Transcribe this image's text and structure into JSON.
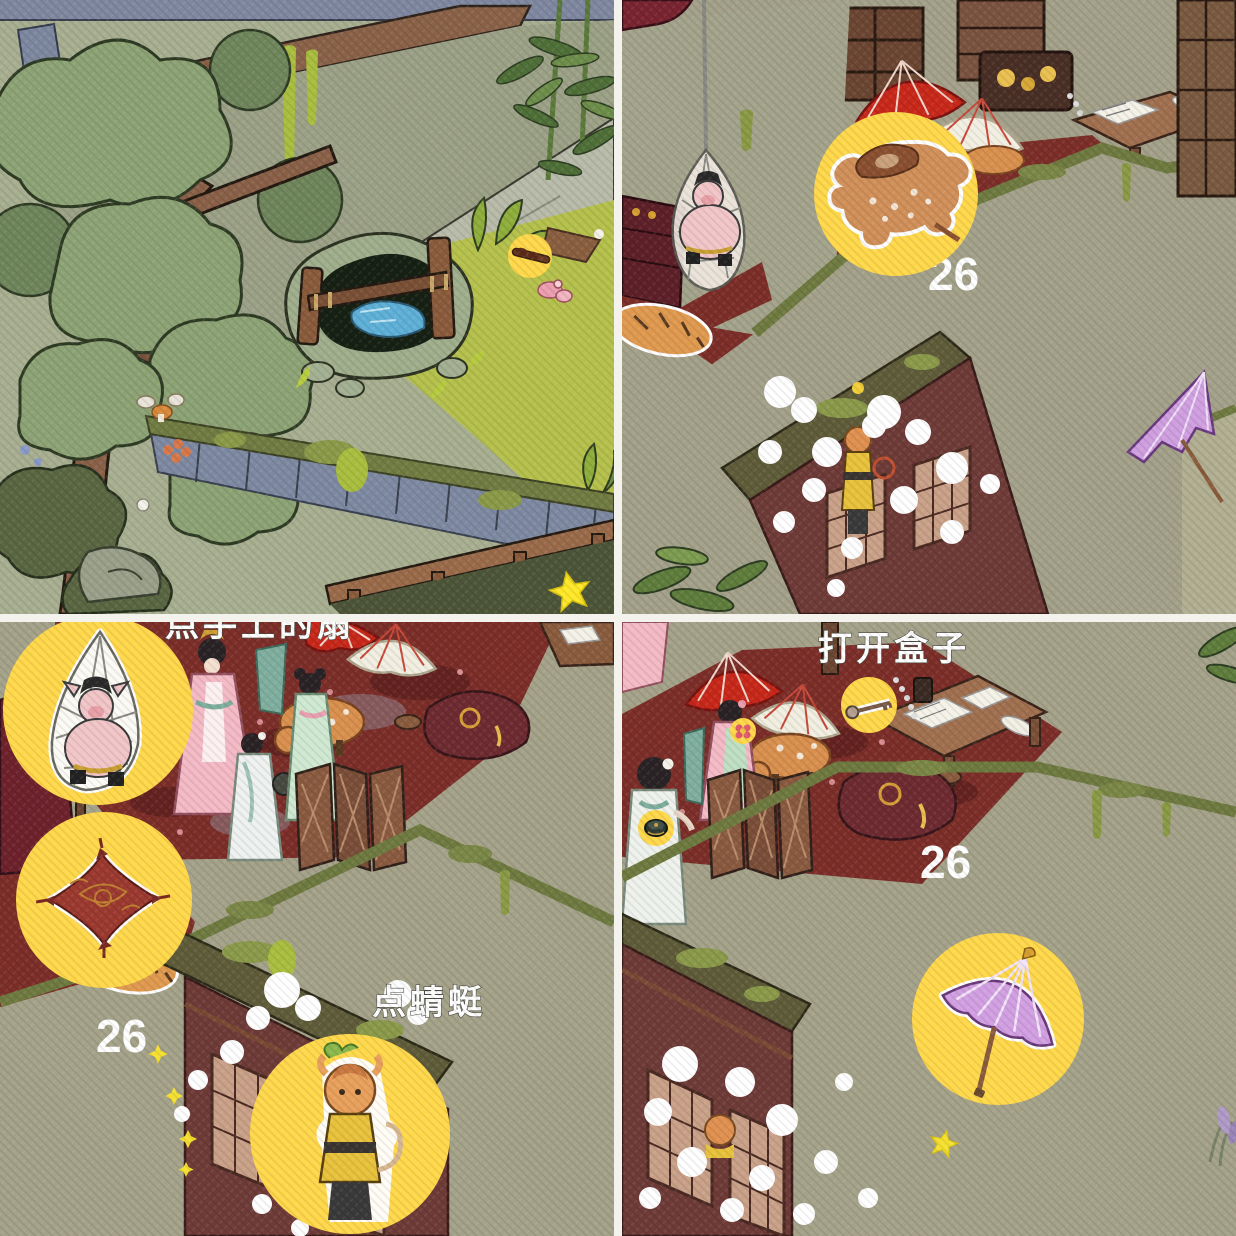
{
  "app": {
    "type": "isometric hidden-object puzzle game — 2x2 screenshot grid",
    "accent_yellow": "#FFD84B",
    "counter_color": "#FFFFFF"
  },
  "quadrants": {
    "top_left": {
      "scene": "mossy garden with stone spring, ginkgo trees, bamboo and tiled wall",
      "hints": [
        {
          "icon": "stick-skewer-icon"
        }
      ],
      "decor": [
        "yellow-star",
        "pink-blossom",
        "mushrooms",
        "white-dot"
      ]
    },
    "top_right": {
      "scene": "attic room with ladies, pig in hanging net, umbrellas, monkey in smoke",
      "counter": "26",
      "hints": [
        {
          "icon": "deer-pelt-sticker"
        }
      ],
      "decor": [
        "exclamation-marker",
        "purple-umbrella",
        "red-umbrella",
        "white-umbrella"
      ]
    },
    "bottom_left": {
      "scene": "same room closer: ladies, folding screen, deer, lattice house",
      "counter": "26",
      "instruction_top": "点手上的扇",
      "instruction": "点蜻蜓",
      "hints": [
        {
          "icon": "pig-in-net-sticker"
        },
        {
          "icon": "red-cushion-sticker"
        },
        {
          "icon": "monkey-sticker"
        }
      ],
      "decor": [
        "sparkle-stars",
        "smoke-clouds",
        "tiger-pelt"
      ]
    },
    "bottom_right": {
      "scene": "room right side: desk with papers, round table, ladies, smoke clouds",
      "counter": "26",
      "instruction": "打开盒子",
      "hints": [
        {
          "icon": "key-sticker"
        },
        {
          "icon": "flower-sticker"
        },
        {
          "icon": "round-box-sticker"
        },
        {
          "icon": "purple-umbrella-sticker"
        }
      ],
      "decor": [
        "yellow-star",
        "bead-chain",
        "lavender-plant"
      ]
    }
  }
}
